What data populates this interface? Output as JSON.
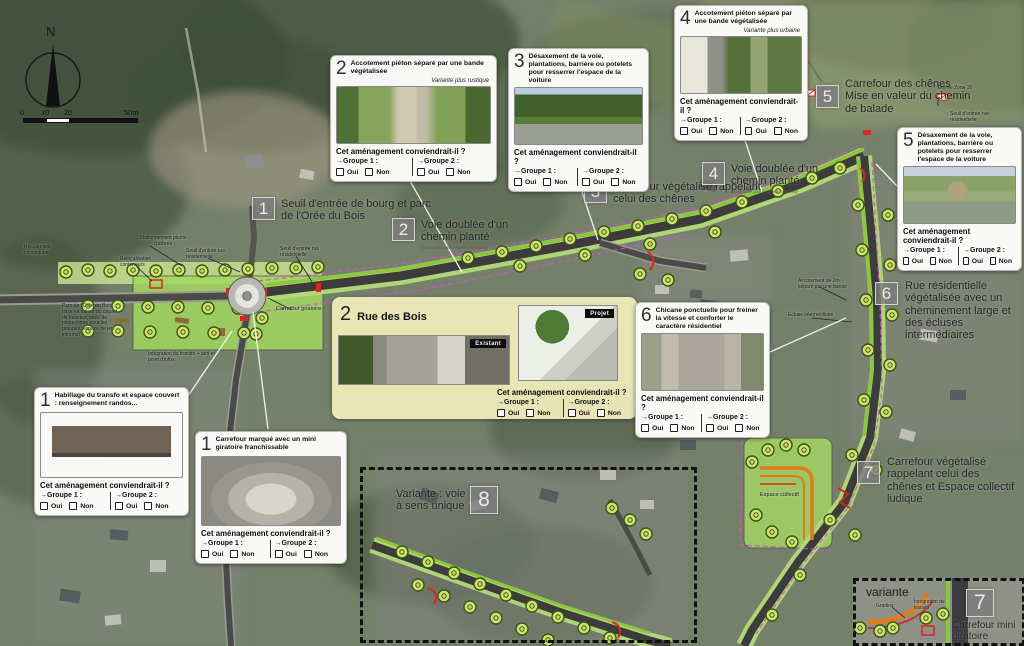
{
  "compass": {
    "north": "N"
  },
  "scalebar": {
    "t0": "0",
    "t10": "10",
    "t20": "20",
    "t50": "50m"
  },
  "question": {
    "prompt": "Cet aménagement conviendrait-il ?",
    "group1": "→Groupe 1 :",
    "group2": "→Groupe 2 :",
    "oui": "Oui",
    "non": "Non"
  },
  "cards": {
    "c1a": {
      "num": "1",
      "title": "Habillage du transfo et espace couvert : renseignement randos..."
    },
    "c1b": {
      "num": "1",
      "title": "Carrefour marqué avec un mini giratoire franchissable"
    },
    "c2": {
      "num": "2",
      "title": "Accotement piéton séparé par une bande végétalisée",
      "variant": "Variante plus rustique"
    },
    "c3": {
      "num": "3",
      "title": "Désaxement de la voie, plantations, barrière ou potelets pour resserrer l'espace de la voiture"
    },
    "c4": {
      "num": "4",
      "title": "Accotement piéton séparé par une bande végétalisée",
      "variant": "Variante plus urbaine"
    },
    "c5": {
      "num": "5",
      "title": "Désaxement de la voie, plantations, barrière ou potelets pour resserrer l'espace de la voiture"
    },
    "c6": {
      "num": "6",
      "title": "Chicane ponctuelle pour freiner la vitesse et conforter le caractère résidentiel"
    }
  },
  "feature": {
    "num": "2",
    "title": "Rue des Bois",
    "badge_existing": "Existant",
    "badge_project": "Projet"
  },
  "labels": {
    "l1": {
      "num": "1",
      "text": "Seuil d'entrée de bourg et parc de l'Orée du Bois"
    },
    "l2": {
      "num": "2",
      "text": "Voie doublée d'un chemin planté",
      "sub": "(nécessite une emprise foncière)"
    },
    "l3": {
      "num": "3",
      "text": "Carrefour végétalisé rappelant celui des chênes"
    },
    "l4": {
      "num": "4",
      "text": "Voie doublée d'un chemin planté",
      "sub": "(nécessite une emprise foncière)"
    },
    "l5": {
      "num": "5",
      "text": "Carrefour des chênes Mise en valeur du chemin de balade"
    },
    "l6": {
      "num": "6",
      "text": "Rue résidentielle végétalisée avec un cheminement large et des écluses intermédiaires"
    },
    "l7": {
      "num": "7",
      "text": "Carrefour végétalisé rappelant celui des chênes et Espace collectif ludique"
    },
    "l8": {
      "num": "8",
      "text": "Variante : voie à sens unique"
    },
    "l7b": {
      "num": "7",
      "text": "Carrefour mini giratoire"
    },
    "variante": "variante"
  },
  "map_notes": {
    "stationnement": "Stationnement planté d'arbres",
    "relocalisation": "Relocalisation conteneurs",
    "reculement": "Reculement conséquent",
    "seuil_rue_a": "Seuil d'entrée rue résidentielle",
    "seuil_rue_b": "Seuil d'entrée rue résidentielle",
    "seuil_rue_c": "Seuil d'entrée rue résidentielle",
    "entree_zone30": "Entrée Zone 30",
    "carrefour_giratoire": "Carrefour giratoire",
    "parc": "Parc de l'Orée du Bois mise en valeur du départ de balades, table de pique-nique pour les groupes, espace de jeu informel",
    "integration_transfo": "Intégration du transfo + abri et point d'infos",
    "accotement": "Accotement de 2m séparé par une bande",
    "ecluse": "Écluse intermédiaire",
    "espace_collectif": "Espace collectif",
    "gradins": "Gradins",
    "integration_transfo2": "Intégration du transfo"
  }
}
